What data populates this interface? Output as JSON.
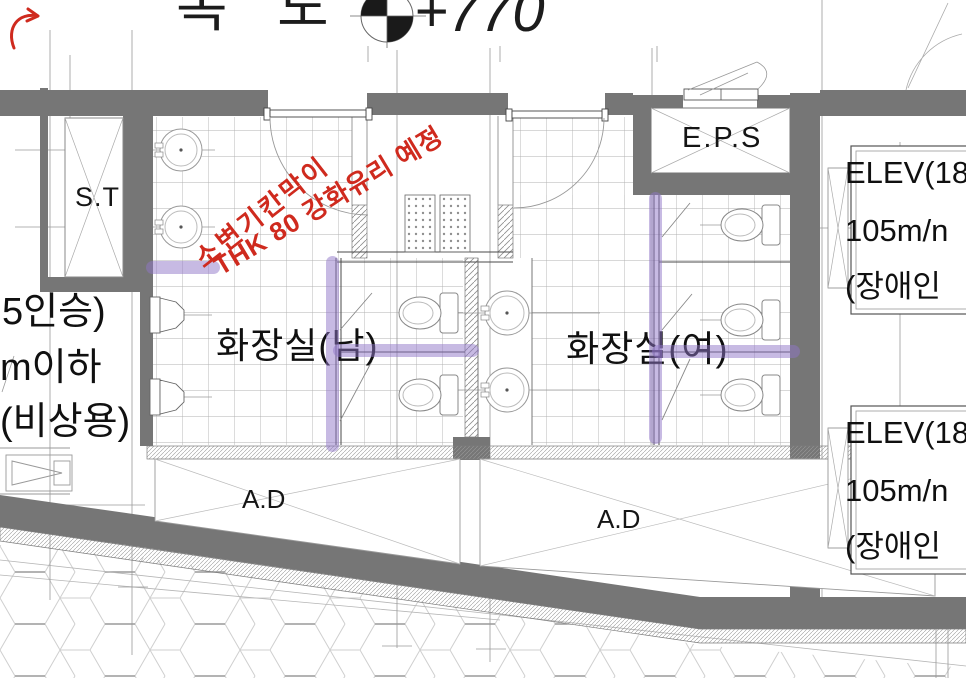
{
  "title": {
    "corridor": "복 도",
    "level": "+770"
  },
  "rooms": {
    "mens": "화장실(남)",
    "womens": "화장실(여)",
    "eps": "E.P.S",
    "shaft": "S.T",
    "air_duct_left": "A.D",
    "air_duct_right": "A.D"
  },
  "left_elevator": {
    "line1": "5인승)",
    "line2": "m이하",
    "line3": "(비상용)"
  },
  "elevator_top": {
    "line1": "ELEV(18",
    "line2": "105m/n",
    "line3": "(장애인"
  },
  "elevator_bottom": {
    "line1": "ELEV(18",
    "line2": "105m/n",
    "line3": "(장애인"
  },
  "red_annotation": {
    "line1": "소변기칸막이",
    "line2": "THK 80 강화유리 예정"
  },
  "colors": {
    "wall_gray": "#767676",
    "highlighter_purple": "#9076c8",
    "annotation_red": "#cf2a1e"
  }
}
